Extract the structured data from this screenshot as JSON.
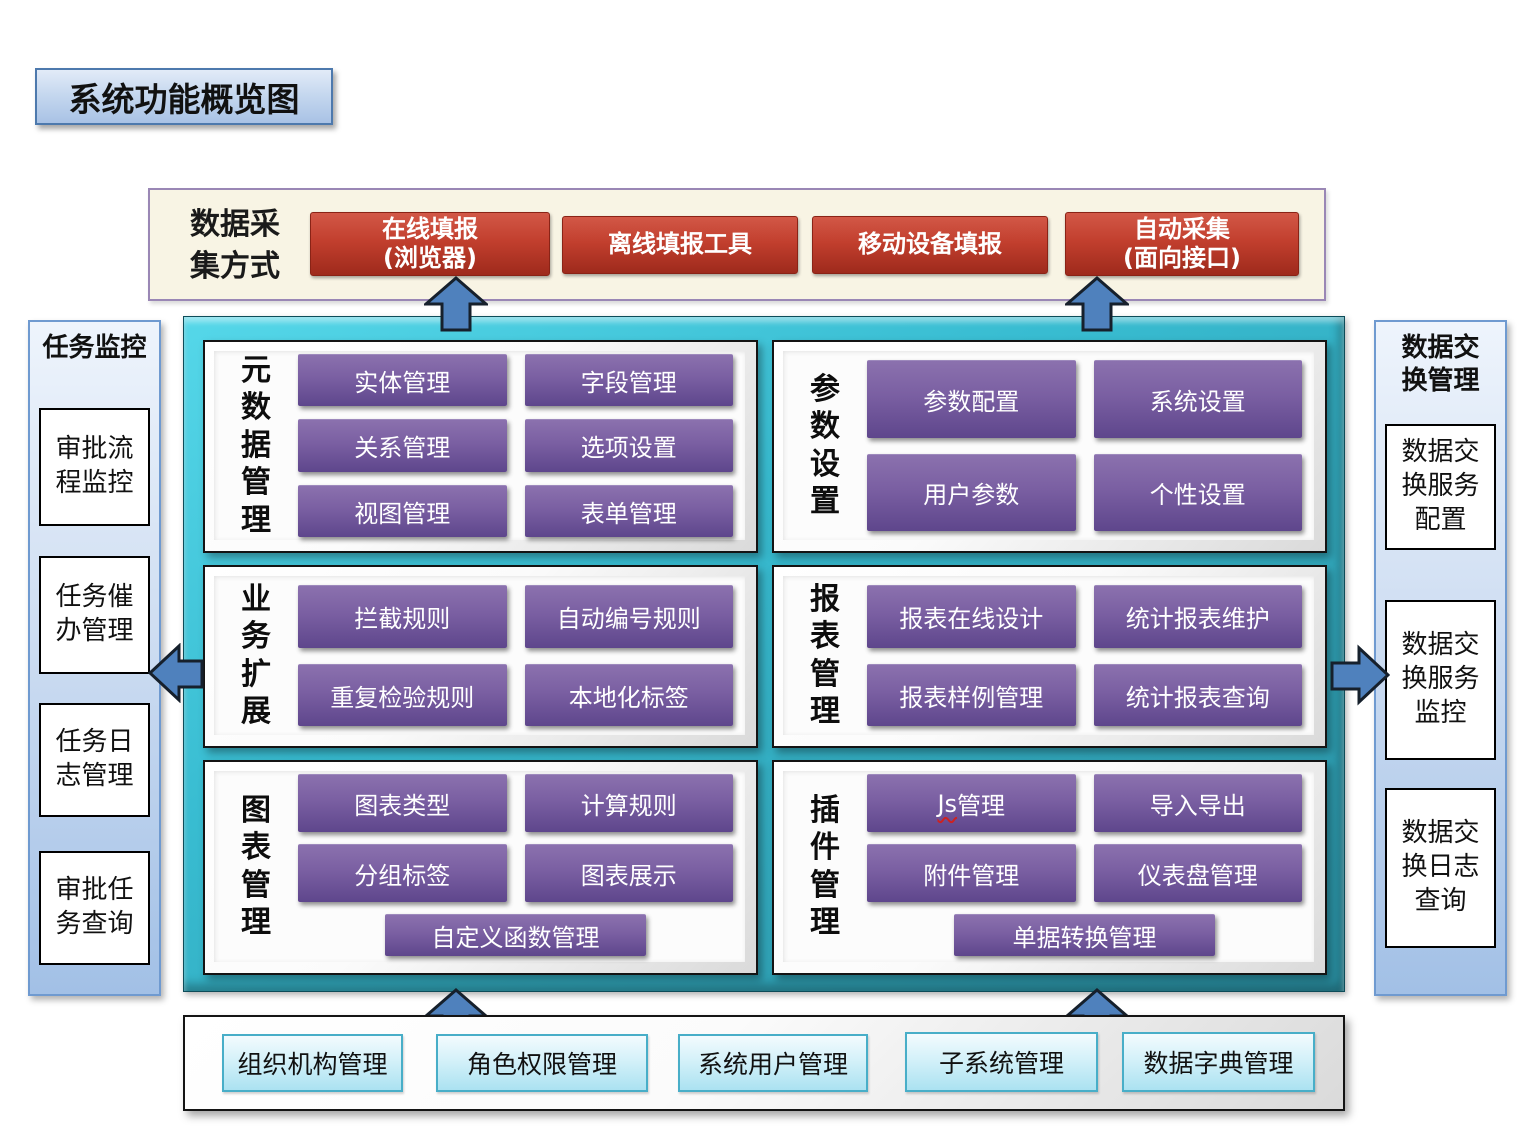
{
  "title": "系统功能概览图",
  "data_collection": {
    "label": "数据采集方式",
    "methods": [
      {
        "label": "在线填报\n(浏览器)"
      },
      {
        "label": "离线填报工具"
      },
      {
        "label": "移动设备填报"
      },
      {
        "label": "自动采集\n(面向接口)"
      }
    ]
  },
  "task_monitor": {
    "title": "任务监控",
    "items": [
      "审批流程监控",
      "任务催办管理",
      "任务日志管理",
      "审批任务查询"
    ]
  },
  "data_exchange": {
    "title": "数据交换管理",
    "items": [
      "数据交换服务配置",
      "数据交换服务监控",
      "数据交换日志查询"
    ]
  },
  "panels": [
    {
      "label": "元数据管理",
      "buttons": [
        "实体管理",
        "字段管理",
        "关系管理",
        "选项设置",
        "视图管理",
        "表单管理"
      ]
    },
    {
      "label": "参数设置",
      "buttons": [
        "参数配置",
        "系统设置",
        "用户参数",
        "个性设置"
      ]
    },
    {
      "label": "业务扩展",
      "buttons": [
        "拦截规则",
        "自动编号规则",
        "重复检验规则",
        "本地化标签"
      ]
    },
    {
      "label": "报表管理",
      "buttons": [
        "报表在线设计",
        "统计报表维护",
        "报表样例管理",
        "统计报表查询"
      ]
    },
    {
      "label": "图表管理",
      "buttons": [
        "图表类型",
        "计算规则",
        "分组标签",
        "图表展示"
      ],
      "wide_button": "自定义函数管理"
    },
    {
      "label": "插件管理",
      "js_button": {
        "prefix": "Js",
        "suffix": "管理"
      },
      "buttons": [
        "导入导出",
        "附件管理",
        "仪表盘管理"
      ],
      "wide_button": "单据转换管理"
    }
  ],
  "foundation": {
    "items": [
      "组织机构管理",
      "角色权限管理",
      "系统用户管理",
      "子系统管理",
      "数据字典管理"
    ]
  },
  "colors": {
    "red_button": "#b5372a",
    "purple_button": "#71579b",
    "teal_container": "#31a9bd",
    "blue_arrow": "#4f81bd",
    "cream_band": "#f8f4e4",
    "cyan_button_border": "#48aec8"
  }
}
